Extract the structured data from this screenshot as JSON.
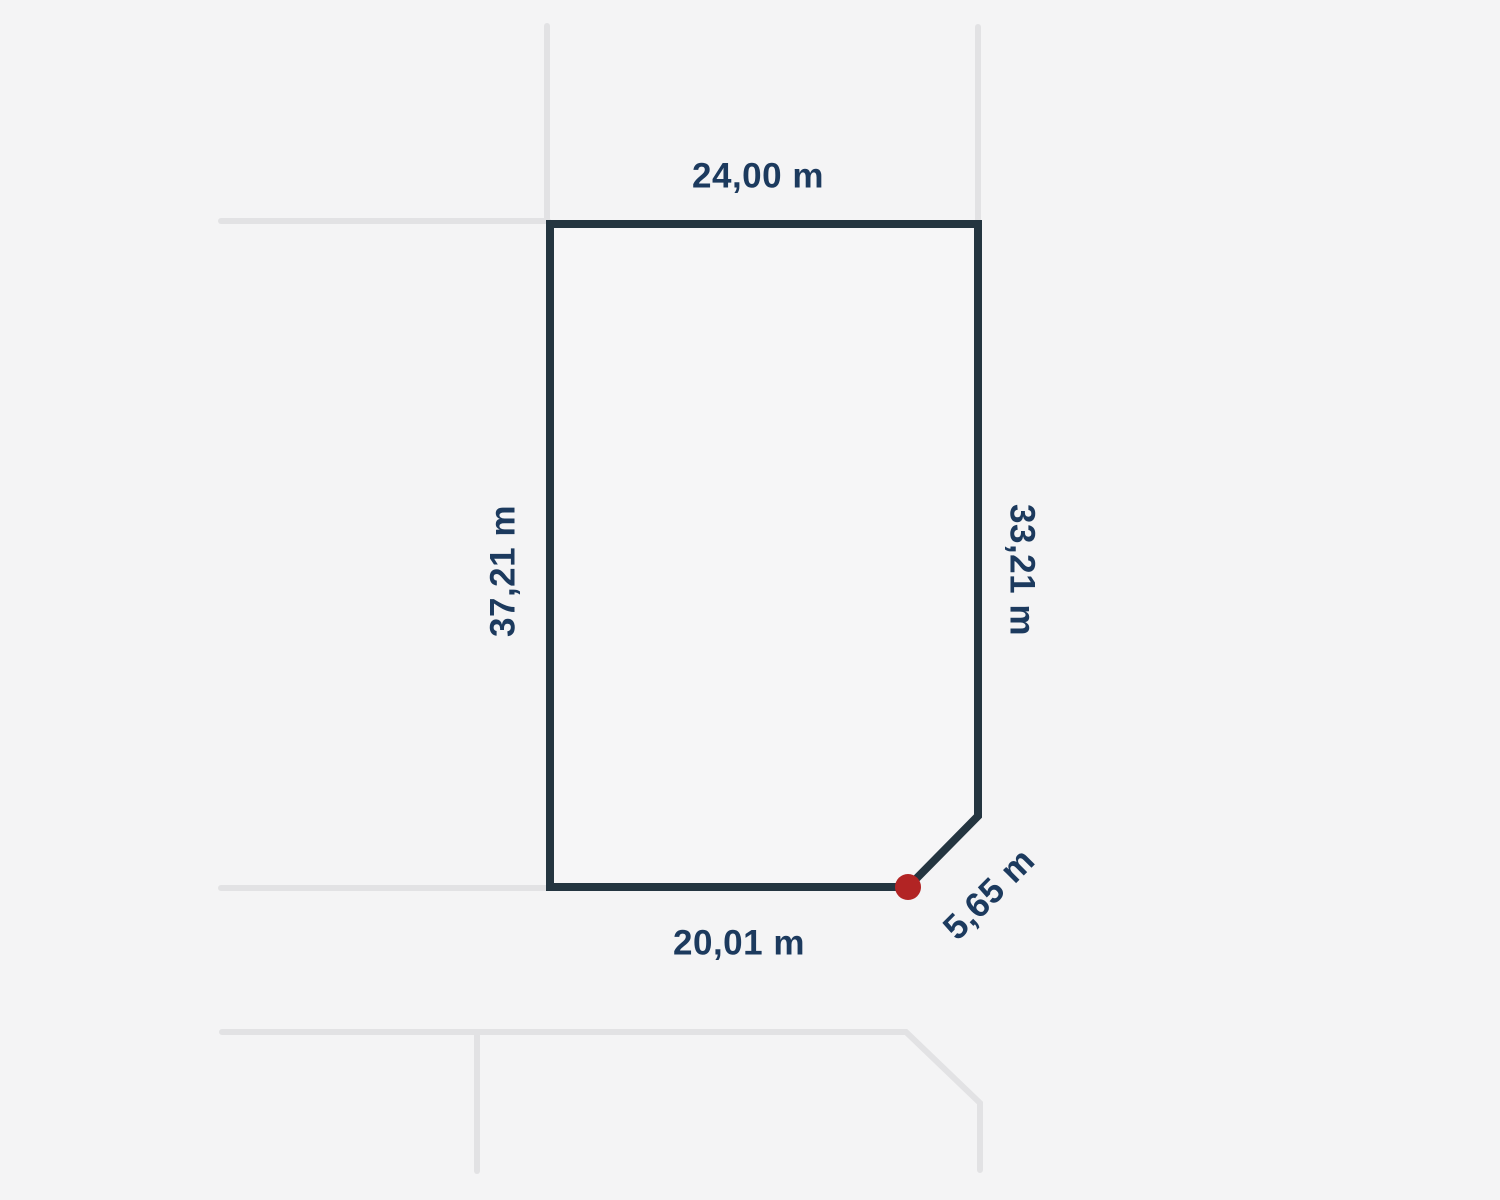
{
  "page": {
    "background_color": "#f4f4f5"
  },
  "diagram": {
    "type": "land-parcel-plan",
    "colors": {
      "parcel_outline": "#243540",
      "parcel_fill": "#f6f6f7",
      "neighbor_line": "#e2e2e4",
      "label_text": "#1c3a5e",
      "vertex_dot": "#b22424"
    },
    "labels": {
      "top": "24,00 m",
      "left": "37,21 m",
      "right": "33,21 m",
      "bottom": "20,01 m",
      "corner": "5,65 m"
    },
    "dimensions_m": {
      "top": 24.0,
      "left": 37.21,
      "right": 33.21,
      "bottom": 20.01,
      "corner_cut": 5.65
    }
  }
}
